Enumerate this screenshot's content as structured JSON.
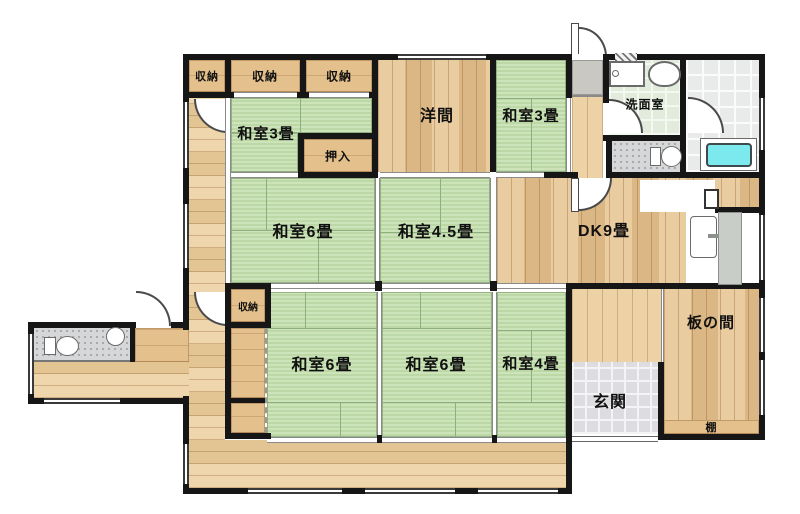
{
  "rooms": {
    "closet_a": "収納",
    "closet_b": "収納",
    "closet_c": "収納",
    "washitsu3_tl": "和室3畳",
    "oshiire": "押入",
    "youma": "洋間",
    "washitsu3_c": "和室3畳",
    "senmen": "洗面室",
    "washitsu6_m": "和室6畳",
    "washitsu45": "和室4.5畳",
    "dk": "DK9畳",
    "closet_mid": "収納",
    "washitsu6_bl": "和室6畳",
    "washitsu6_bm": "和室6畳",
    "washitsu4": "和室4畳",
    "itanoma": "板の間",
    "genkan": "玄関",
    "tana": "棚"
  },
  "fixtures": {
    "bathtub": "bathtub",
    "wash_counter": "sink-counter",
    "wash_basin": "washbasin",
    "toilet_upper": "toilet",
    "toilet_lower": "toilet",
    "hand_basin": "round-basin",
    "kitchen_sink": "kitchen-sink",
    "water_heater": "water-heater",
    "kitchen_counter": "counter"
  },
  "colors": {
    "wall": "#161616",
    "tatami": "#c2dcae",
    "wood": "#e6c492",
    "corridor_wood": "#eccf9e",
    "bathtub": "#7ce9ef",
    "genkan_tile": "#dcdce1",
    "bath_tile": "#e9ebeb",
    "wash_floor": "#e2ebdc",
    "wc_floor": "#d6d7d9",
    "kitchen_counter": "#c9cdc8"
  }
}
